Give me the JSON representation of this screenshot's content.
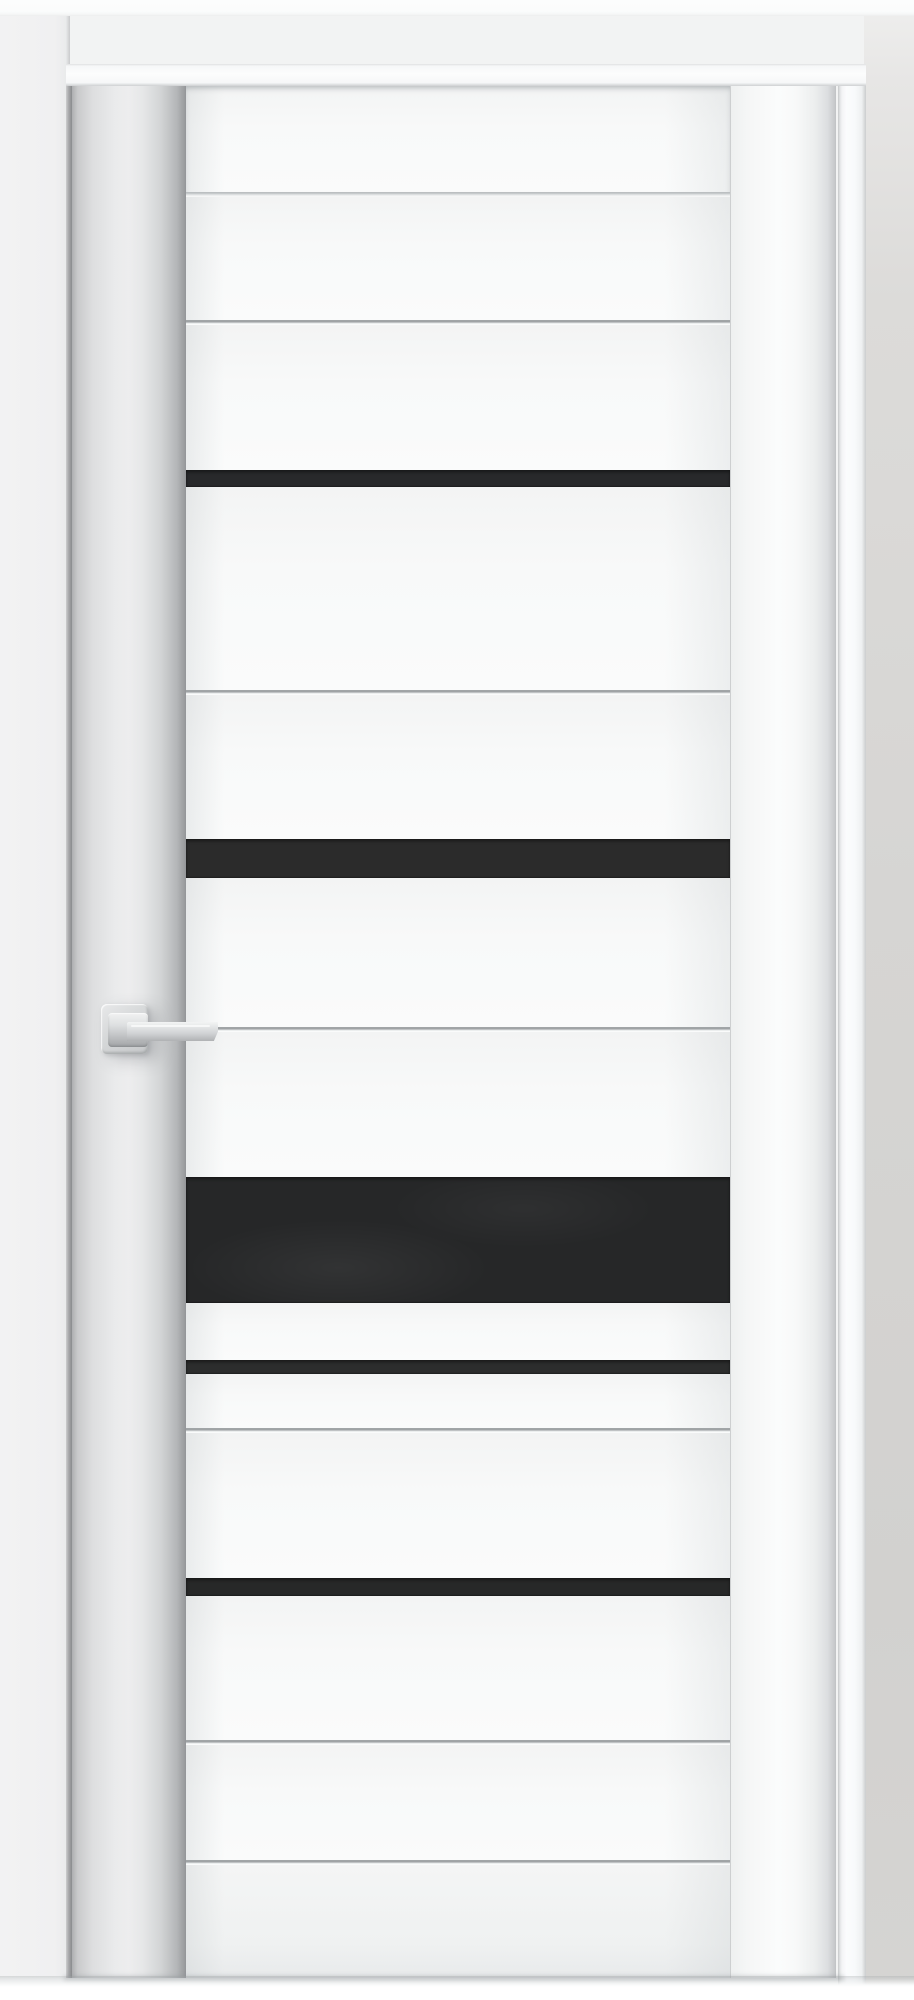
{
  "scene": {
    "subject": "Closed white interior door with five horizontal black glass inserts, square-rose satin-chrome lever handle, white casing and light gray walls",
    "width_px": 914,
    "height_px": 2000
  },
  "palette": {
    "wall_left": "#f0f0f1",
    "wall_above_door": "#f2f3f3",
    "wall_right": "#d6d5d3",
    "ceiling_strip": "#fbfcfc",
    "casing_white": "#fcfdfd",
    "door_face": "#f8f9f9",
    "stile_shadow": "#9d9fa1",
    "groove_line": "#9ea2a4",
    "glass_black": "#28292a",
    "handle_metal": "#d7d9da",
    "floor_white": "#ffffff"
  },
  "rects": {
    "top_band": {
      "x": 0,
      "y": 0,
      "w": 914,
      "h": 16
    },
    "wall_left": {
      "x": 0,
      "y": 0,
      "w": 70,
      "h": 1976
    },
    "wall_right": {
      "x": 864,
      "y": 0,
      "w": 50,
      "h": 1990
    },
    "jamb_right": {
      "x": 838,
      "y": 64,
      "w": 28,
      "h": 1926
    },
    "casing_top": {
      "x": 66,
      "y": 64,
      "w": 800,
      "h": 22
    },
    "reveal_left": {
      "x": 66,
      "y": 84,
      "w": 6,
      "h": 1894
    },
    "door": {
      "x": 72,
      "y": 86,
      "w": 764,
      "h": 1892
    },
    "stile_left": {
      "x": 72,
      "y": 86,
      "w": 114,
      "h": 1892
    },
    "stile_right": {
      "x": 730,
      "y": 86,
      "w": 106,
      "h": 1892
    },
    "panel_stack": {
      "x": 186,
      "y": 86,
      "w": 544,
      "h": 1892
    },
    "rose": {
      "x": 101,
      "y": 1004,
      "w": 47,
      "h": 50
    },
    "collar": {
      "x": 108,
      "y": 1013,
      "w": 40,
      "h": 34
    },
    "lever": {
      "x": 127,
      "y": 1022,
      "w": 91,
      "h": 19
    },
    "floor": {
      "x": 0,
      "y": 1976,
      "w": 914,
      "h": 24
    }
  },
  "door": {
    "slab": {
      "left": 72,
      "right": 836,
      "top": 86,
      "bottom": 1978
    },
    "stile_joints_x": [
      186,
      730
    ],
    "glass_inserts_count": 5,
    "handle_side": "left"
  },
  "segments": [
    {
      "name": "top-rail",
      "type": "board",
      "extra": "toprail",
      "from": 86,
      "to": 192
    },
    {
      "name": "rail-joint",
      "type": "joint",
      "from": 192,
      "to": 197
    },
    {
      "name": "board-1",
      "type": "board",
      "from": 197,
      "to": 320
    },
    {
      "name": "groove-1",
      "type": "groove",
      "from": 320,
      "to": 325
    },
    {
      "name": "board-2",
      "type": "board",
      "from": 325,
      "to": 470
    },
    {
      "name": "glass-insert-1",
      "type": "glass",
      "color": "#28292b",
      "from": 470,
      "to": 487
    },
    {
      "name": "board-3",
      "type": "board",
      "from": 487,
      "to": 690
    },
    {
      "name": "groove-2",
      "type": "groove",
      "from": 690,
      "to": 695
    },
    {
      "name": "board-4",
      "type": "board",
      "from": 695,
      "to": 839
    },
    {
      "name": "glass-insert-2",
      "type": "glass",
      "color": "#2b2b2b",
      "from": 839,
      "to": 878
    },
    {
      "name": "board-5",
      "type": "board",
      "from": 878,
      "to": 1027
    },
    {
      "name": "groove-3-handle-line",
      "type": "groove",
      "from": 1027,
      "to": 1032
    },
    {
      "name": "board-6",
      "type": "board",
      "from": 1032,
      "to": 1177
    },
    {
      "name": "glass-insert-3-wide",
      "type": "glass",
      "extra": "large",
      "color": "#262728",
      "from": 1177,
      "to": 1303
    },
    {
      "name": "board-7",
      "type": "board",
      "from": 1303,
      "to": 1360
    },
    {
      "name": "glass-insert-4",
      "type": "glass",
      "color": "#2c2d2d",
      "from": 1360,
      "to": 1374
    },
    {
      "name": "board-8",
      "type": "board",
      "from": 1374,
      "to": 1428
    },
    {
      "name": "groove-4",
      "type": "groove",
      "from": 1428,
      "to": 1433
    },
    {
      "name": "board-9",
      "type": "board",
      "from": 1433,
      "to": 1578
    },
    {
      "name": "glass-insert-5",
      "type": "glass",
      "color": "#272828",
      "from": 1578,
      "to": 1596
    },
    {
      "name": "board-10",
      "type": "board",
      "from": 1596,
      "to": 1740
    },
    {
      "name": "groove-5",
      "type": "groove",
      "from": 1740,
      "to": 1745
    },
    {
      "name": "board-11",
      "type": "board",
      "from": 1745,
      "to": 1860
    },
    {
      "name": "groove-6",
      "type": "groove",
      "from": 1860,
      "to": 1865
    },
    {
      "name": "bottom-rail",
      "type": "board",
      "extra": "bottomrail",
      "from": 1865,
      "to": 1978
    }
  ],
  "handle": {
    "style": "square rose with straight lever",
    "finish": "satin chrome / aluminum",
    "mounted_on": "left stile",
    "lever_points": "right"
  }
}
